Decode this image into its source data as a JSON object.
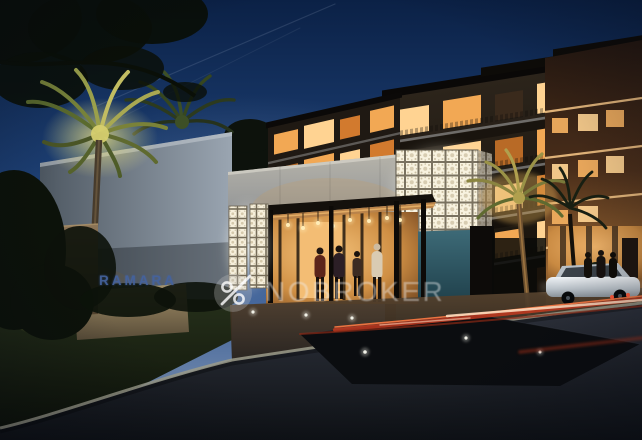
{
  "scene": {
    "description": "Night architectural rendering of an apartment complex entrance: glowing white jali lattice gatehouse and panels, flat entrance canopy with pendant lights, residents walking in, palm trees, a stone lawn sign, curved driveway with car light trails and a parked white car, all under a deep blue dusk sky.",
    "sign": {
      "text": "RAMARA"
    },
    "watermark": {
      "brand": "NOBROKER",
      "icon": "no-brokerage-percent-icon",
      "opacity": 0.42
    },
    "colors": {
      "sky_top": "#0b2146",
      "sky_horizon": "#8195b4",
      "building_facade": "#1d1610",
      "window_warm": "#f2a854",
      "lattice_glow": "#f8f2df",
      "concrete_wall": "#9aa5b1",
      "boundary_wall": "#b7b4aa",
      "teal_wall": "#3d6a77",
      "canopy_soffit": "#b9834a",
      "palm_lit": "#c2bd62",
      "lawn": "#1a2412",
      "road": "#14171c",
      "curb": "#9b9b8a",
      "light_trail_red": "#c23a20",
      "light_trail_white": "#ffe2c4",
      "sign_text": "#44639f",
      "pedestal_stone": "#8d7c5b",
      "watermark_text": "#eeeeee"
    }
  }
}
